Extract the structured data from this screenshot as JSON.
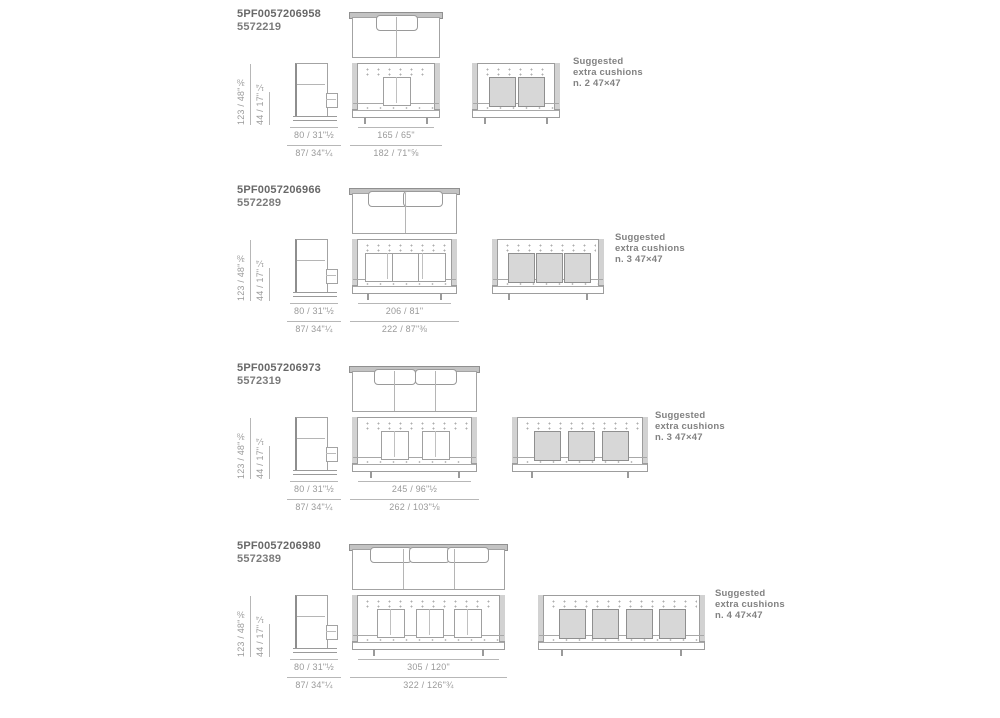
{
  "rows": [
    {
      "code_primary": "5PF0057206958",
      "code_secondary": "5572219",
      "dims": {
        "height_total": "123 / 48\"⅜",
        "seat_height": "44 / 17\"¼",
        "depth_seat": "80 / 31\"½",
        "depth_total": "87/ 34\"¼",
        "width_seat": "165 / 65\"",
        "width_total": "182 / 71\"⅝"
      },
      "suggested_line1": "Suggested",
      "suggested_line2": "extra cushions",
      "suggested_line3": "n. 2 47×47",
      "drawing": {
        "top_pillows": 1,
        "top_seams": 1,
        "back_pillows": 1,
        "front_seams": 1,
        "extra_cushions": 2
      }
    },
    {
      "code_primary": "5PF0057206966",
      "code_secondary": "5572289",
      "dims": {
        "height_total": "123 / 48\"⅜",
        "seat_height": "44 / 17\"¼",
        "depth_seat": "80 / 31\"½",
        "depth_total": "87/ 34\"¼",
        "width_seat": "206 / 81\"",
        "width_total": "222 / 87\"⅜"
      },
      "suggested_line1": "Suggested",
      "suggested_line2": "extra cushions",
      "suggested_line3": "n. 3 47×47",
      "drawing": {
        "top_pillows": 2,
        "top_seams": 1,
        "back_pillows": 3,
        "front_seams": 2,
        "extra_cushions": 3
      }
    },
    {
      "code_primary": "5PF0057206973",
      "code_secondary": "5572319",
      "dims": {
        "height_total": "123 / 48\"⅜",
        "seat_height": "44 / 17\"¼",
        "depth_seat": "80 / 31\"½",
        "depth_total": "87/ 34\"¼",
        "width_seat": "245 / 96\"½",
        "width_total": "262 / 103\"⅛"
      },
      "suggested_line1": "Suggested",
      "suggested_line2": "extra cushions",
      "suggested_line3": "n. 3 47×47",
      "drawing": {
        "top_pillows": 2,
        "top_seams": 2,
        "back_pillows": 2,
        "front_seams": 2,
        "extra_cushions": 3
      }
    },
    {
      "code_primary": "5PF0057206980",
      "code_secondary": "5572389",
      "dims": {
        "height_total": "123 / 48\"⅜",
        "seat_height": "44 / 17\"¼",
        "depth_seat": "80 / 31\"½",
        "depth_total": "87/ 34\"¼",
        "width_seat": "305 / 120\"",
        "width_total": "322 / 126\"¾"
      },
      "suggested_line1": "Suggested",
      "suggested_line2": "extra cushions",
      "suggested_line3": "n. 4 47×47",
      "drawing": {
        "top_pillows": 3,
        "top_seams": 2,
        "back_pillows": 3,
        "front_seams": 3,
        "extra_cushions": 4
      }
    }
  ]
}
